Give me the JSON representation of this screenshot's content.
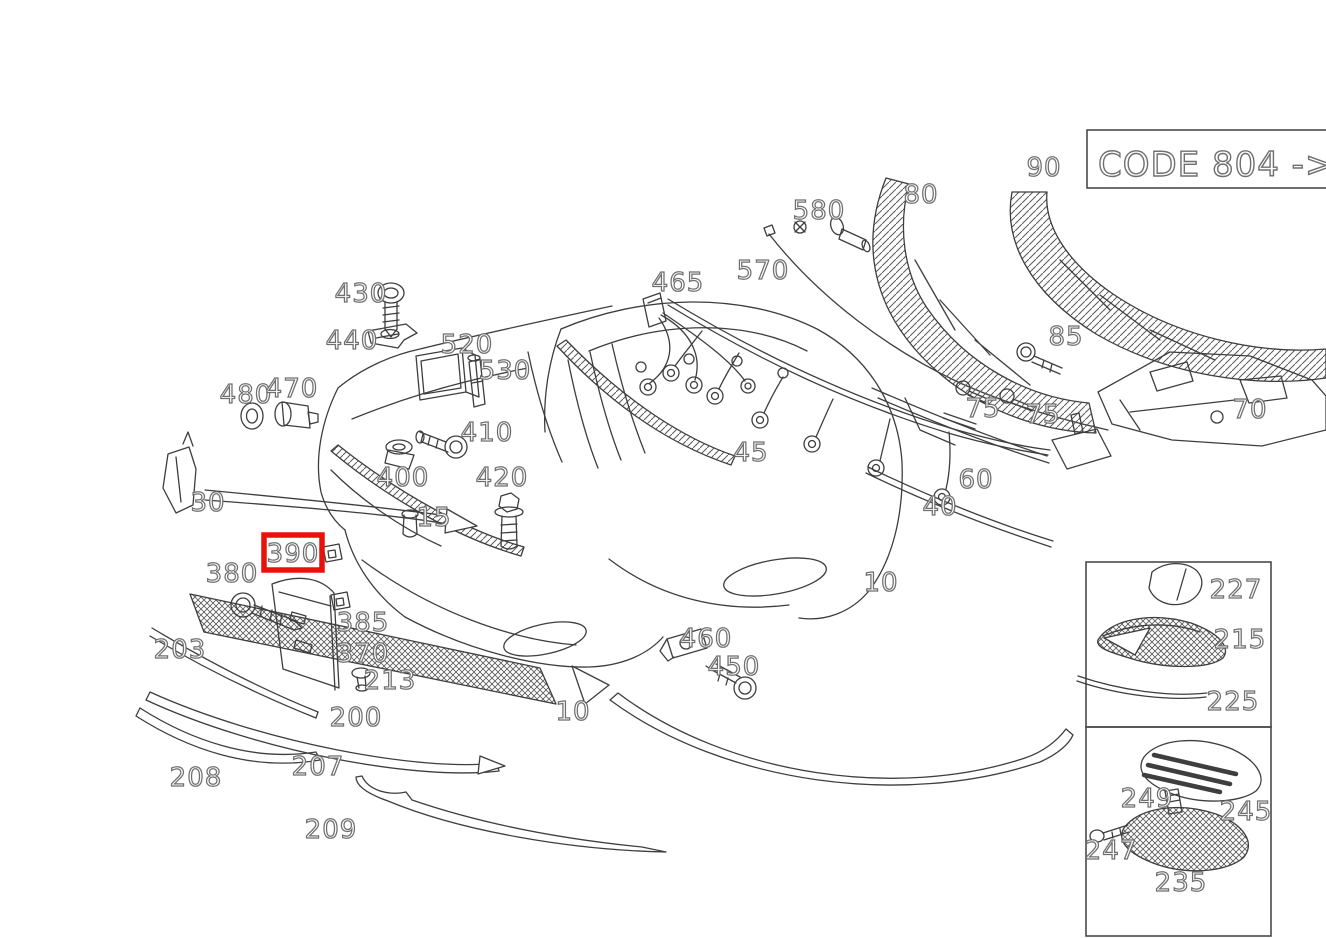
{
  "code_box": {
    "label": "CODE 804 ->"
  },
  "highlight": {
    "part": "390",
    "color": "#e8120c"
  },
  "colors": {
    "background": "#ffffff",
    "line": "#3e3e3e",
    "label_outline": "#6f6f6f",
    "highlight": "#e8120c"
  },
  "labels": [
    {
      "text": "430"
    },
    {
      "text": "440"
    },
    {
      "text": "520"
    },
    {
      "text": "530"
    },
    {
      "text": "480"
    },
    {
      "text": "470"
    },
    {
      "text": "410"
    },
    {
      "text": "400"
    },
    {
      "text": "420"
    },
    {
      "text": "15"
    },
    {
      "text": "30"
    },
    {
      "text": "390"
    },
    {
      "text": "380"
    },
    {
      "text": "385"
    },
    {
      "text": "370"
    },
    {
      "text": "203"
    },
    {
      "text": "213"
    },
    {
      "text": "200"
    },
    {
      "text": "208"
    },
    {
      "text": "207"
    },
    {
      "text": "209"
    },
    {
      "text": "10"
    },
    {
      "text": "10"
    },
    {
      "text": "460"
    },
    {
      "text": "450"
    },
    {
      "text": "465"
    },
    {
      "text": "570"
    },
    {
      "text": "580"
    },
    {
      "text": "45"
    },
    {
      "text": "80"
    },
    {
      "text": "90"
    },
    {
      "text": "85"
    },
    {
      "text": "75"
    },
    {
      "text": "75"
    },
    {
      "text": "70"
    },
    {
      "text": "60"
    },
    {
      "text": "40"
    },
    {
      "text": "227"
    },
    {
      "text": "215"
    },
    {
      "text": "225"
    },
    {
      "text": "249"
    },
    {
      "text": "245"
    },
    {
      "text": "247"
    },
    {
      "text": "235"
    }
  ]
}
